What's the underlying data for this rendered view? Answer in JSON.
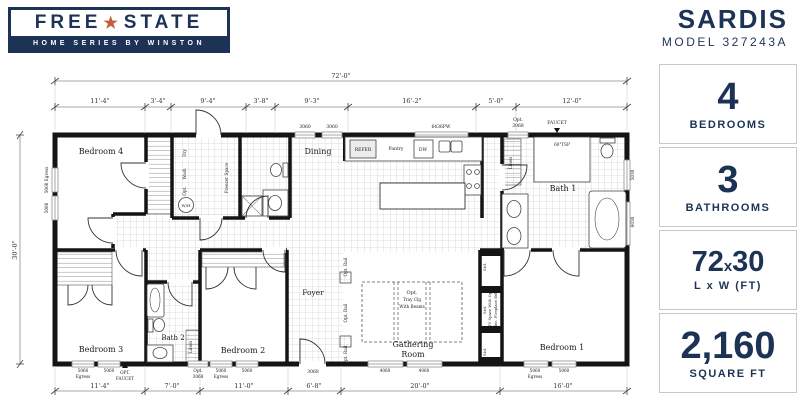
{
  "brand": {
    "line1_left": "FREE",
    "line1_star": "★",
    "line1_right": "STATE",
    "line2": "HOME SERIES BY WINSTON"
  },
  "header": {
    "model_name": "SARDIS",
    "model_code": "MODEL 327243A"
  },
  "stats": [
    {
      "value": "4",
      "label": "BEDROOMS"
    },
    {
      "value": "3",
      "label": "BATHROOMS"
    },
    {
      "value": "72",
      "x": "x",
      "value2": "30",
      "label": "L x W (FT)"
    },
    {
      "value": "2,160",
      "label": "SQUARE FT"
    }
  ],
  "plan": {
    "dims": {
      "overall_w": "72'-0\"",
      "overall_h": "30'-0\"",
      "top": [
        "11'-4\"",
        "3'-4\"",
        "9'-4\"",
        "3'-8\"",
        "9'-3\"",
        "16'-2\"",
        "5'-0\"",
        "12'-0\""
      ],
      "bottom": [
        "11'-4\"",
        "7'-0\"",
        "11'-0\"",
        "6'-8\"",
        "20'-0\"",
        "16'-0\""
      ]
    },
    "rooms": {
      "bedroom4": "Bedroom 4",
      "bedroom3": "Bedroom 3",
      "bedroom2": "Bedroom 2",
      "bedroom1": "Bedroom 1",
      "bath1": "Bath 1",
      "bath2": "Bath 2",
      "dining": "Dining",
      "foyer": "Foyer",
      "gathering1": "Gathering",
      "gathering2": "Room"
    },
    "labels": {
      "refer": "REFER",
      "pantry": "Pantry",
      "dw": "DW",
      "wash": "Wash",
      "dry": "Dry",
      "opt": "Opt.",
      "wh": "W/H",
      "freezer": "Freezer Space",
      "linen": "Linen",
      "faucet": "FAUCET",
      "opt_upper": "OPT.",
      "tsp": "60\"TSP",
      "tray1": "Opt.",
      "tray2": "Tray Clg",
      "tray3": "With Beams",
      "rail": "Opt. Rail",
      "std": "Std.",
      "niche1": "TV Space With Opt.",
      "niche2": "Elec. Fireplace Below",
      "door3068": "3068"
    },
    "windows": {
      "n5060": "5060",
      "egress": "Egress",
      "left1": "5060 Egress",
      "n3060": "3060",
      "pw": "6436PW",
      "n4060": "4060",
      "n5030": "5030",
      "n6030": "6030"
    }
  }
}
